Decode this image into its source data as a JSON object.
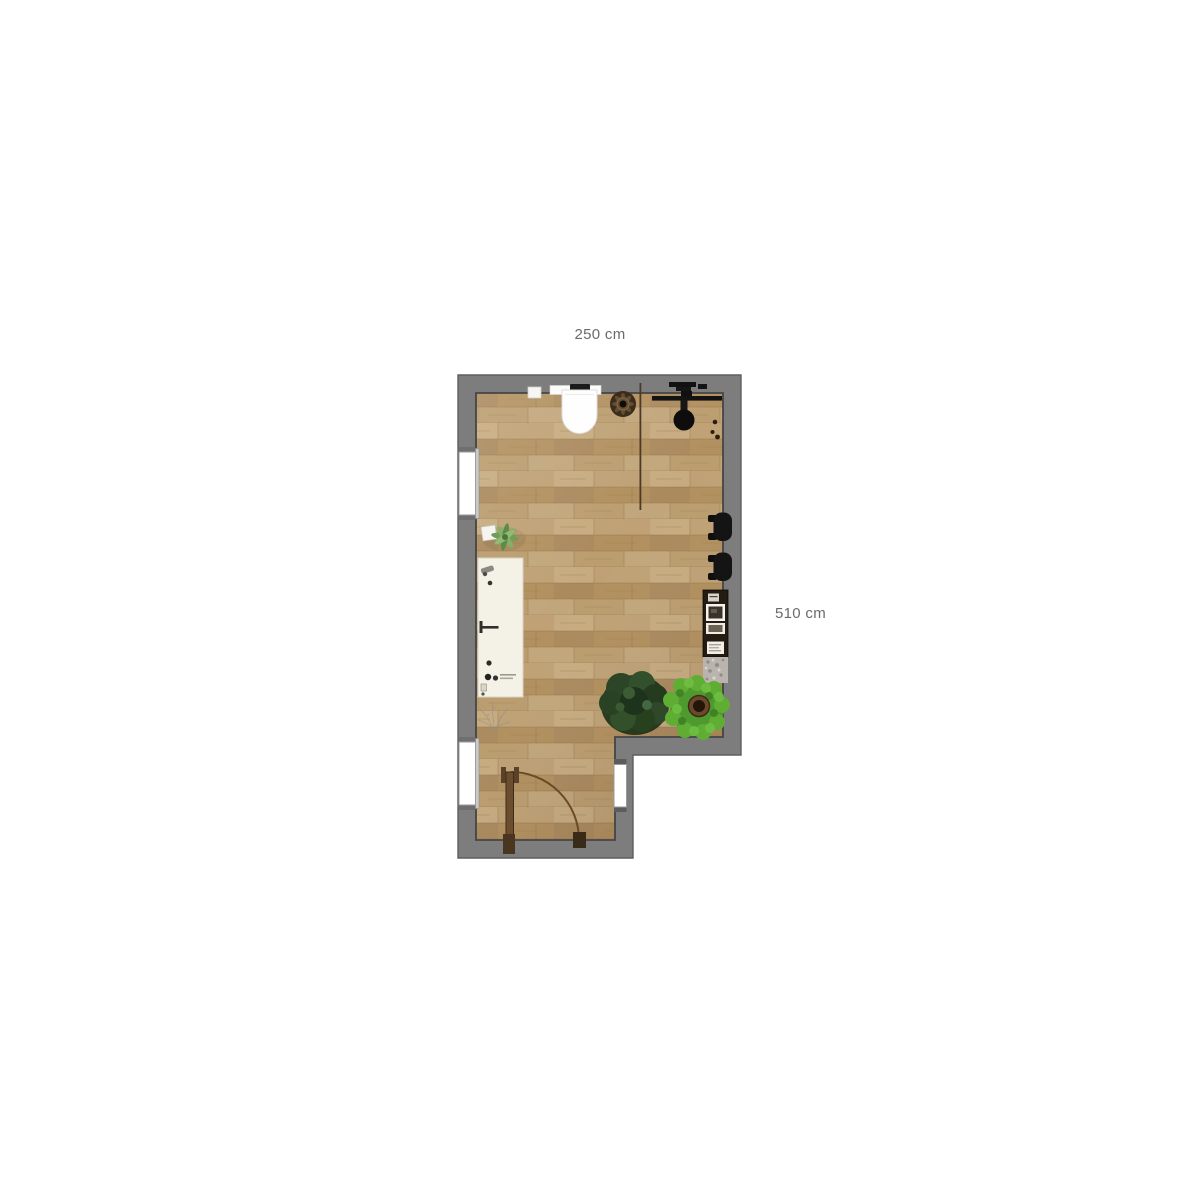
{
  "floor_plan": {
    "dimension_labels": {
      "width": "250 cm",
      "height": "510 cm"
    },
    "room": {
      "shape": "L-shaped",
      "floor_material": "wood-planks",
      "openings": [
        "window-upper-left",
        "window-lower-left",
        "entry-door-bottom",
        "window-lower-right-wall"
      ]
    },
    "fixtures": [
      "wall-hung-toilet",
      "flush-plate",
      "wall-box",
      "ceiling-fan",
      "room-divider-line",
      "clothes-rail",
      "hanging-items",
      "pendant-round-seat",
      "wall-hooks",
      "aloe-plant",
      "vanity-counter",
      "counter-faucet",
      "counter-handle",
      "toiletry-items",
      "sketch-plant",
      "wall-sconce-upper",
      "wall-sconce-lower",
      "display-shelf",
      "stone-mat",
      "dark-green-plant",
      "light-green-potted-plant",
      "door-leaf",
      "door-swing-arc"
    ],
    "colors": {
      "background": "#ffffff",
      "wall": "#7d7d7d",
      "wall_outline": "#4a4a4a",
      "floor_base": "#b6956a",
      "floor_light": "#c7ab80",
      "floor_dark": "#a68756",
      "counter": "#f4f1e7",
      "plant_dark": "#2c4526",
      "plant_light": "#5fae33",
      "door_wood": "#6a4e2e",
      "label_text": "#6b6b6b",
      "fixture_black": "#141414"
    }
  }
}
